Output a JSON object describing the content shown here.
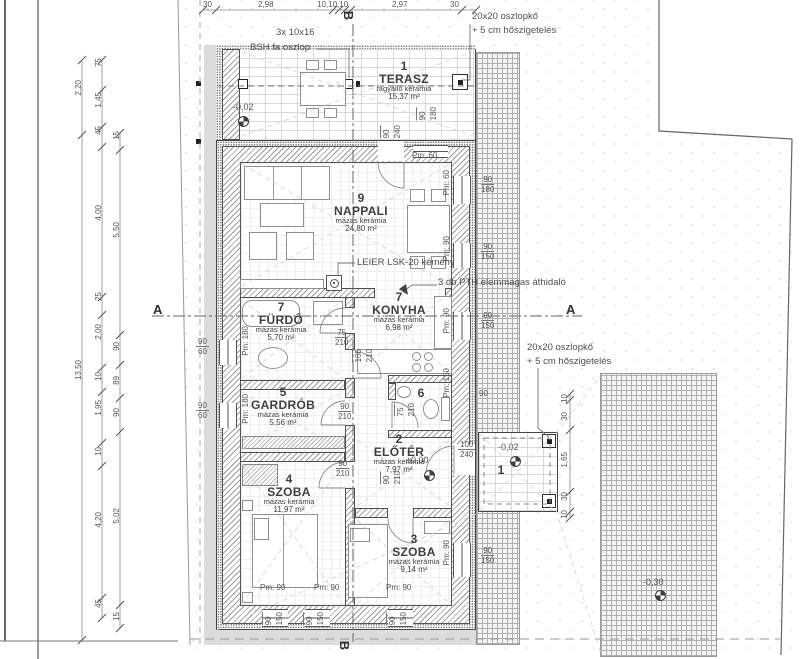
{
  "drawing_type": "floor-plan",
  "rooms": [
    {
      "id": "terasz",
      "num": "1",
      "name": "TERASZ",
      "finish": "fagyálló kerámia",
      "area": "15,37 m²",
      "cx": 404,
      "cy": 60
    },
    {
      "id": "nappali",
      "num": "9",
      "name": "NAPPALI",
      "finish": "mázas kerámia",
      "area": "24,80 m²",
      "cx": 361,
      "cy": 192
    },
    {
      "id": "furdo",
      "num": "7",
      "name": "FÜRDŐ",
      "finish": "mázas kerámia",
      "area": "5,70 m²",
      "cx": 281,
      "cy": 301
    },
    {
      "id": "konyha",
      "num": "7",
      "name": "KONYHA",
      "finish": "mázas kerámia",
      "area": "6,98 m²",
      "cx": 399,
      "cy": 291
    },
    {
      "id": "gardrob",
      "num": "5",
      "name": "GARDRÓB",
      "finish": "mázas kerámia",
      "area": "5,56 m²",
      "cx": 283,
      "cy": 386
    },
    {
      "id": "wc",
      "num": "6",
      "name": "",
      "finish": "",
      "area": "",
      "cx": 421,
      "cy": 387
    },
    {
      "id": "eloter",
      "num": "2",
      "name": "ELŐTÉR",
      "finish": "mázas kerámia",
      "area": "7,97 m²",
      "cx": 399,
      "cy": 433
    },
    {
      "id": "szoba4",
      "num": "4",
      "name": "SZOBA",
      "finish": "mázas kerámia",
      "area": "11,97 m²",
      "cx": 289,
      "cy": 473
    },
    {
      "id": "szoba3",
      "num": "3",
      "name": "SZOBA",
      "finish": "mázas kerámia",
      "area": "9,14 m²",
      "cx": 414,
      "cy": 533
    },
    {
      "id": "porch",
      "num": "1",
      "name": "",
      "finish": "",
      "area": "",
      "cx": 501,
      "cy": 464
    }
  ],
  "annotations": [
    {
      "t": "3x 10x16",
      "x": 276,
      "y": 27
    },
    {
      "t": "BSH fa oszlop",
      "x": 250,
      "y": 42
    },
    {
      "t": "20x20 oszlopkő",
      "x": 472,
      "y": 11
    },
    {
      "t": "+ 5 cm hőszigetelés",
      "x": 472,
      "y": 25
    },
    {
      "t": "20x20 oszlopkő",
      "x": 527,
      "y": 342
    },
    {
      "t": "+ 5 cm hőszigetelés",
      "x": 527,
      "y": 356
    },
    {
      "t": "LEIER LSK-20 kémény",
      "x": 357,
      "y": 257
    },
    {
      "t": "3 db PTH elemmagas áthidaló",
      "x": 438,
      "y": 277
    }
  ],
  "levels": [
    {
      "t": "-0,02",
      "x": 233,
      "y": 103,
      "mx": 238,
      "my": 116
    },
    {
      "t": "±0,00",
      "x": 406,
      "y": 456,
      "mx": 424,
      "my": 470
    },
    {
      "t": "-0,02",
      "x": 498,
      "y": 443,
      "mx": 510,
      "my": 456
    },
    {
      "t": "-0,30",
      "x": 643,
      "y": 578,
      "mx": 655,
      "my": 590
    }
  ],
  "sections": [
    {
      "t": "A",
      "x": 153,
      "y": 302,
      "rot": 0
    },
    {
      "t": "A",
      "x": 566,
      "y": 302,
      "rot": 0
    },
    {
      "t": "B",
      "x": 344,
      "y": 8,
      "rot": 1
    },
    {
      "t": "B",
      "x": 340,
      "y": 638,
      "rot": 1
    }
  ],
  "dims_h": [
    {
      "t": "30",
      "x": 203,
      "y": 0
    },
    {
      "t": "2,98",
      "x": 258,
      "y": 0
    },
    {
      "t": "10,10,10",
      "x": 317,
      "y": 0
    },
    {
      "t": "2,97",
      "x": 392,
      "y": 0
    },
    {
      "t": "30",
      "x": 450,
      "y": 0
    },
    {
      "t": "Pm: 60",
      "x": 412,
      "y": 151
    },
    {
      "t": "90",
      "x": 479,
      "y": 389
    },
    {
      "t": "Pm: 90",
      "x": 260,
      "y": 583
    },
    {
      "t": "Pm: 90",
      "x": 314,
      "y": 583
    },
    {
      "t": "Pm: 90",
      "x": 386,
      "y": 583
    }
  ],
  "dims_v": [
    {
      "t": "2,20",
      "x": 74,
      "y": 80
    },
    {
      "t": "13,50",
      "x": 74,
      "y": 360
    },
    {
      "t": "75",
      "x": 94,
      "y": 58
    },
    {
      "t": "1,45",
      "x": 94,
      "y": 92
    },
    {
      "t": "45",
      "x": 94,
      "y": 126
    },
    {
      "t": "4,00",
      "x": 94,
      "y": 205
    },
    {
      "t": "25",
      "x": 94,
      "y": 292
    },
    {
      "t": "2,00",
      "x": 94,
      "y": 324
    },
    {
      "t": "10",
      "x": 94,
      "y": 372
    },
    {
      "t": "1,95",
      "x": 94,
      "y": 400
    },
    {
      "t": "10",
      "x": 94,
      "y": 447
    },
    {
      "t": "4,20",
      "x": 94,
      "y": 512
    },
    {
      "t": "45",
      "x": 94,
      "y": 599
    },
    {
      "t": "15",
      "x": 112,
      "y": 131
    },
    {
      "t": "5,50",
      "x": 112,
      "y": 222
    },
    {
      "t": "90",
      "x": 112,
      "y": 342
    },
    {
      "t": "89",
      "x": 112,
      "y": 376
    },
    {
      "t": "90",
      "x": 112,
      "y": 408
    },
    {
      "t": "5,02",
      "x": 112,
      "y": 508
    },
    {
      "t": "15",
      "x": 112,
      "y": 612
    },
    {
      "t": "Pm: 60",
      "x": 442,
      "y": 170
    },
    {
      "t": "Pm: 90",
      "x": 442,
      "y": 236
    },
    {
      "t": "Pm: 90",
      "x": 442,
      "y": 308
    },
    {
      "t": "Pm: 150",
      "x": 442,
      "y": 368
    },
    {
      "t": "Pm: 90",
      "x": 442,
      "y": 540
    },
    {
      "t": "Pm: 180",
      "x": 241,
      "y": 326
    },
    {
      "t": "Pm: 180",
      "x": 241,
      "y": 394
    },
    {
      "t": "10",
      "x": 560,
      "y": 394
    },
    {
      "t": "30",
      "x": 560,
      "y": 412
    },
    {
      "t": "1,65",
      "x": 560,
      "y": 452
    },
    {
      "t": "30",
      "x": 560,
      "y": 492
    },
    {
      "t": "10",
      "x": 560,
      "y": 510
    }
  ],
  "pairs_h": [
    {
      "a": "90",
      "b": "180",
      "x": 481,
      "y": 175
    },
    {
      "a": "90",
      "b": "150",
      "x": 481,
      "y": 242
    },
    {
      "a": "90",
      "b": "150",
      "x": 481,
      "y": 311
    },
    {
      "a": "90",
      "b": "150",
      "x": 481,
      "y": 546
    },
    {
      "a": "90",
      "b": "60",
      "x": 196,
      "y": 337
    },
    {
      "a": "90",
      "b": "60",
      "x": 196,
      "y": 401
    },
    {
      "a": "75",
      "b": "210",
      "x": 335,
      "y": 328
    },
    {
      "a": "90",
      "b": "210",
      "x": 338,
      "y": 402
    },
    {
      "a": "100",
      "b": "240",
      "x": 458,
      "y": 440
    },
    {
      "a": "90",
      "b": "210",
      "x": 336,
      "y": 459
    }
  ],
  "pairs_v": [
    {
      "a": "90",
      "b": "240",
      "x": 380,
      "y": 125
    },
    {
      "a": "90",
      "b": "180",
      "x": 416,
      "y": 107
    },
    {
      "a": "100",
      "b": "210",
      "x": 352,
      "y": 349
    },
    {
      "a": "75",
      "b": "210",
      "x": 394,
      "y": 403
    },
    {
      "a": "90",
      "b": "210",
      "x": 380,
      "y": 471
    },
    {
      "a": "90",
      "b": "150",
      "x": 262,
      "y": 612
    },
    {
      "a": "90",
      "b": "150",
      "x": 303,
      "y": 612
    },
    {
      "a": "90",
      "b": "150",
      "x": 386,
      "y": 612
    }
  ]
}
